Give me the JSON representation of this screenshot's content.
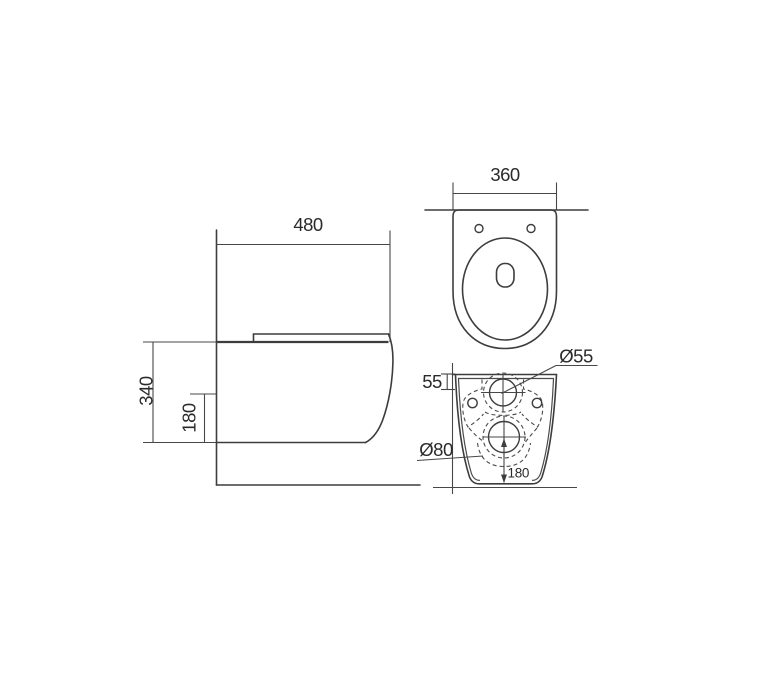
{
  "drawing": {
    "type": "technical-drawing-wall-hung-toilet-three-views",
    "background": "#ffffff",
    "line_color": "#3d3d3d",
    "text_color": "#2a2a2a",
    "side_view": {
      "label_depth": "480",
      "label_height": "340",
      "label_outlet_height": "180"
    },
    "top_view": {
      "label_width": "360"
    },
    "rear_view": {
      "label_inlet_offset": "55",
      "label_inlet_diameter": "Ø55",
      "label_outlet_diameter": "Ø80",
      "label_outlet_height": "180"
    }
  }
}
